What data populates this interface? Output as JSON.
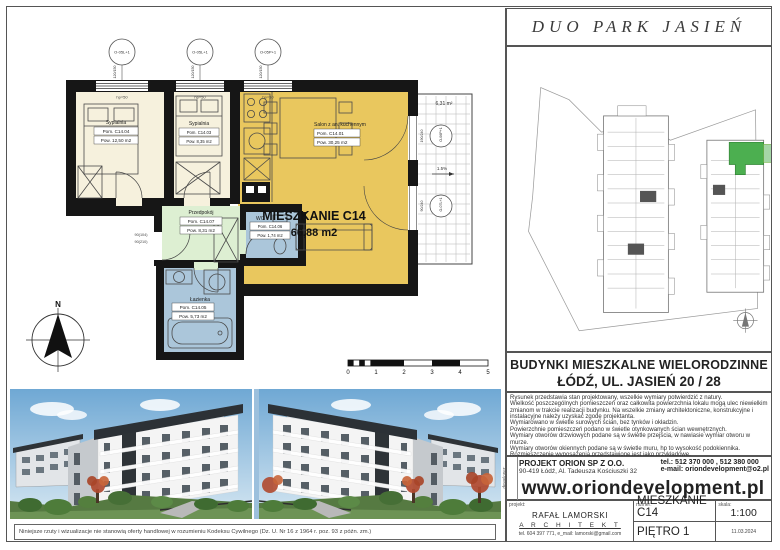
{
  "project_title": "DUO PARK JASIEŃ",
  "plan": {
    "apartment_label": "MIESZKANIE C14",
    "apartment_area": "66,88 m2",
    "rooms": [
      {
        "name": "Sypialnia",
        "id": "Pom. C14.04",
        "area": "Pow. 12,50 m2"
      },
      {
        "name": "Sypialnia",
        "id": "Pom. C14.03",
        "area": "Pow. 8,35 m2"
      },
      {
        "name": "Salon z an. kuchennym",
        "id": "Pom. C14.01",
        "area": "Pow. 30,25 m2"
      },
      {
        "name": "Przedpokój",
        "id": "Pom. C14.07",
        "area": "Pow. 8,31 m2"
      },
      {
        "name": "WC",
        "id": "Pom. C14.06",
        "area": "Pow. 1,74 m2"
      },
      {
        "name": "Łazienka",
        "id": "Pom. C14.05",
        "area": "Pow. 5,73 m2"
      }
    ],
    "balcony_area": "6,31 m²",
    "balcony_slope": "1.5%",
    "window_hp": "hp=50",
    "top_windows": [
      {
        "label": "O-05L+1",
        "dim": "120/150"
      },
      {
        "label": "O-05L+1",
        "dim": "120/150"
      },
      {
        "label": "O-05P+1",
        "dim": "120/150"
      }
    ],
    "balcony_doors": [
      {
        "label": "O-06P+1",
        "dim": "190/240"
      },
      {
        "label": "O-07L+1",
        "dim": "90/240"
      }
    ],
    "entrance_dims": [
      "90(104)",
      "90(210)"
    ],
    "compass_north": "N",
    "scalebar": [
      "0",
      "1",
      "2",
      "3",
      "4",
      "5"
    ]
  },
  "right_panel": {
    "header_line1": "BUDYNKI MIESZKALNE WIELORODZINNE",
    "header_line2": "ŁÓDŹ, UL. JASIEŃ 20 / 28",
    "notes": [
      "Rysunek przedstawia stan projektowany, wszelkie wymiary potwierdzić z natury.",
      "Wielkość poszczególnych pomieszczeń oraz całkowita powierzchnia lokalu mogą ulec niewielkim zmianom w trakcie realizacji budynku. Na wszelkie zmiany architektoniczne, konstrukcyjne i instalacyjne należy uzyskać zgodę projektanta.",
      "Wymiarowano w świetle surowych ścian, bez tynków i okładzin.",
      "Powierzchnie pomieszczeń podano w świetle otynkowanych ścian wewnętrznych.",
      "Wymiary otworów drzwiowych podane są w świetle przejścia, w nawiasie wymiar otworu w murze.",
      "Wymiary otworów okiennych podane są w świetle muru, hp to wysokość podokiennika.",
      "Rozmieszczenie wyposażenia przedstawione jest jako przykładowe."
    ],
    "company": {
      "side_label": "deweloper:",
      "name": "PROJEKT ORION SP Z O.O.",
      "address": "90-419 Łódź, Al. Tadeusza Kościuszki 32",
      "tel": "tel.: 512 370 000 , 512 380 000",
      "email": "e-mail: oriondevelopment@o2.pl",
      "www": "www.oriondevelopment.pl"
    },
    "titleblock": {
      "projekt_label": "projekt:",
      "numer_label": "numer:",
      "skala_label": "skala:",
      "architect_name": "RAFAŁ LAMORSKI",
      "architect_title": "A R C H I T E K T",
      "architect_contact": "tel. 604 397 771,   e_mail: lamorski@gmail.com",
      "numer_value": "MIESZKANIE C14",
      "floor": "PIĘTRO 1",
      "scale_value": "1:100",
      "date": "11.03.2024"
    }
  },
  "footer": {
    "disclaimer": "Niniejsze rzuty i wizualizacje nie stanowią oferty handlowej w rozumieniu Kodeksu Cywilnego (Dz. U. Nr 16 z 1964 r. poz. 93 z późn. zm.)"
  },
  "colors": {
    "wall": "#161616",
    "bedroom_fill": "#f6f1dd",
    "salon_fill": "#e9c75e",
    "hall_fill": "#ddefd2",
    "bath_fill": "#abc6da",
    "highlight_unit": "#4caf50"
  }
}
